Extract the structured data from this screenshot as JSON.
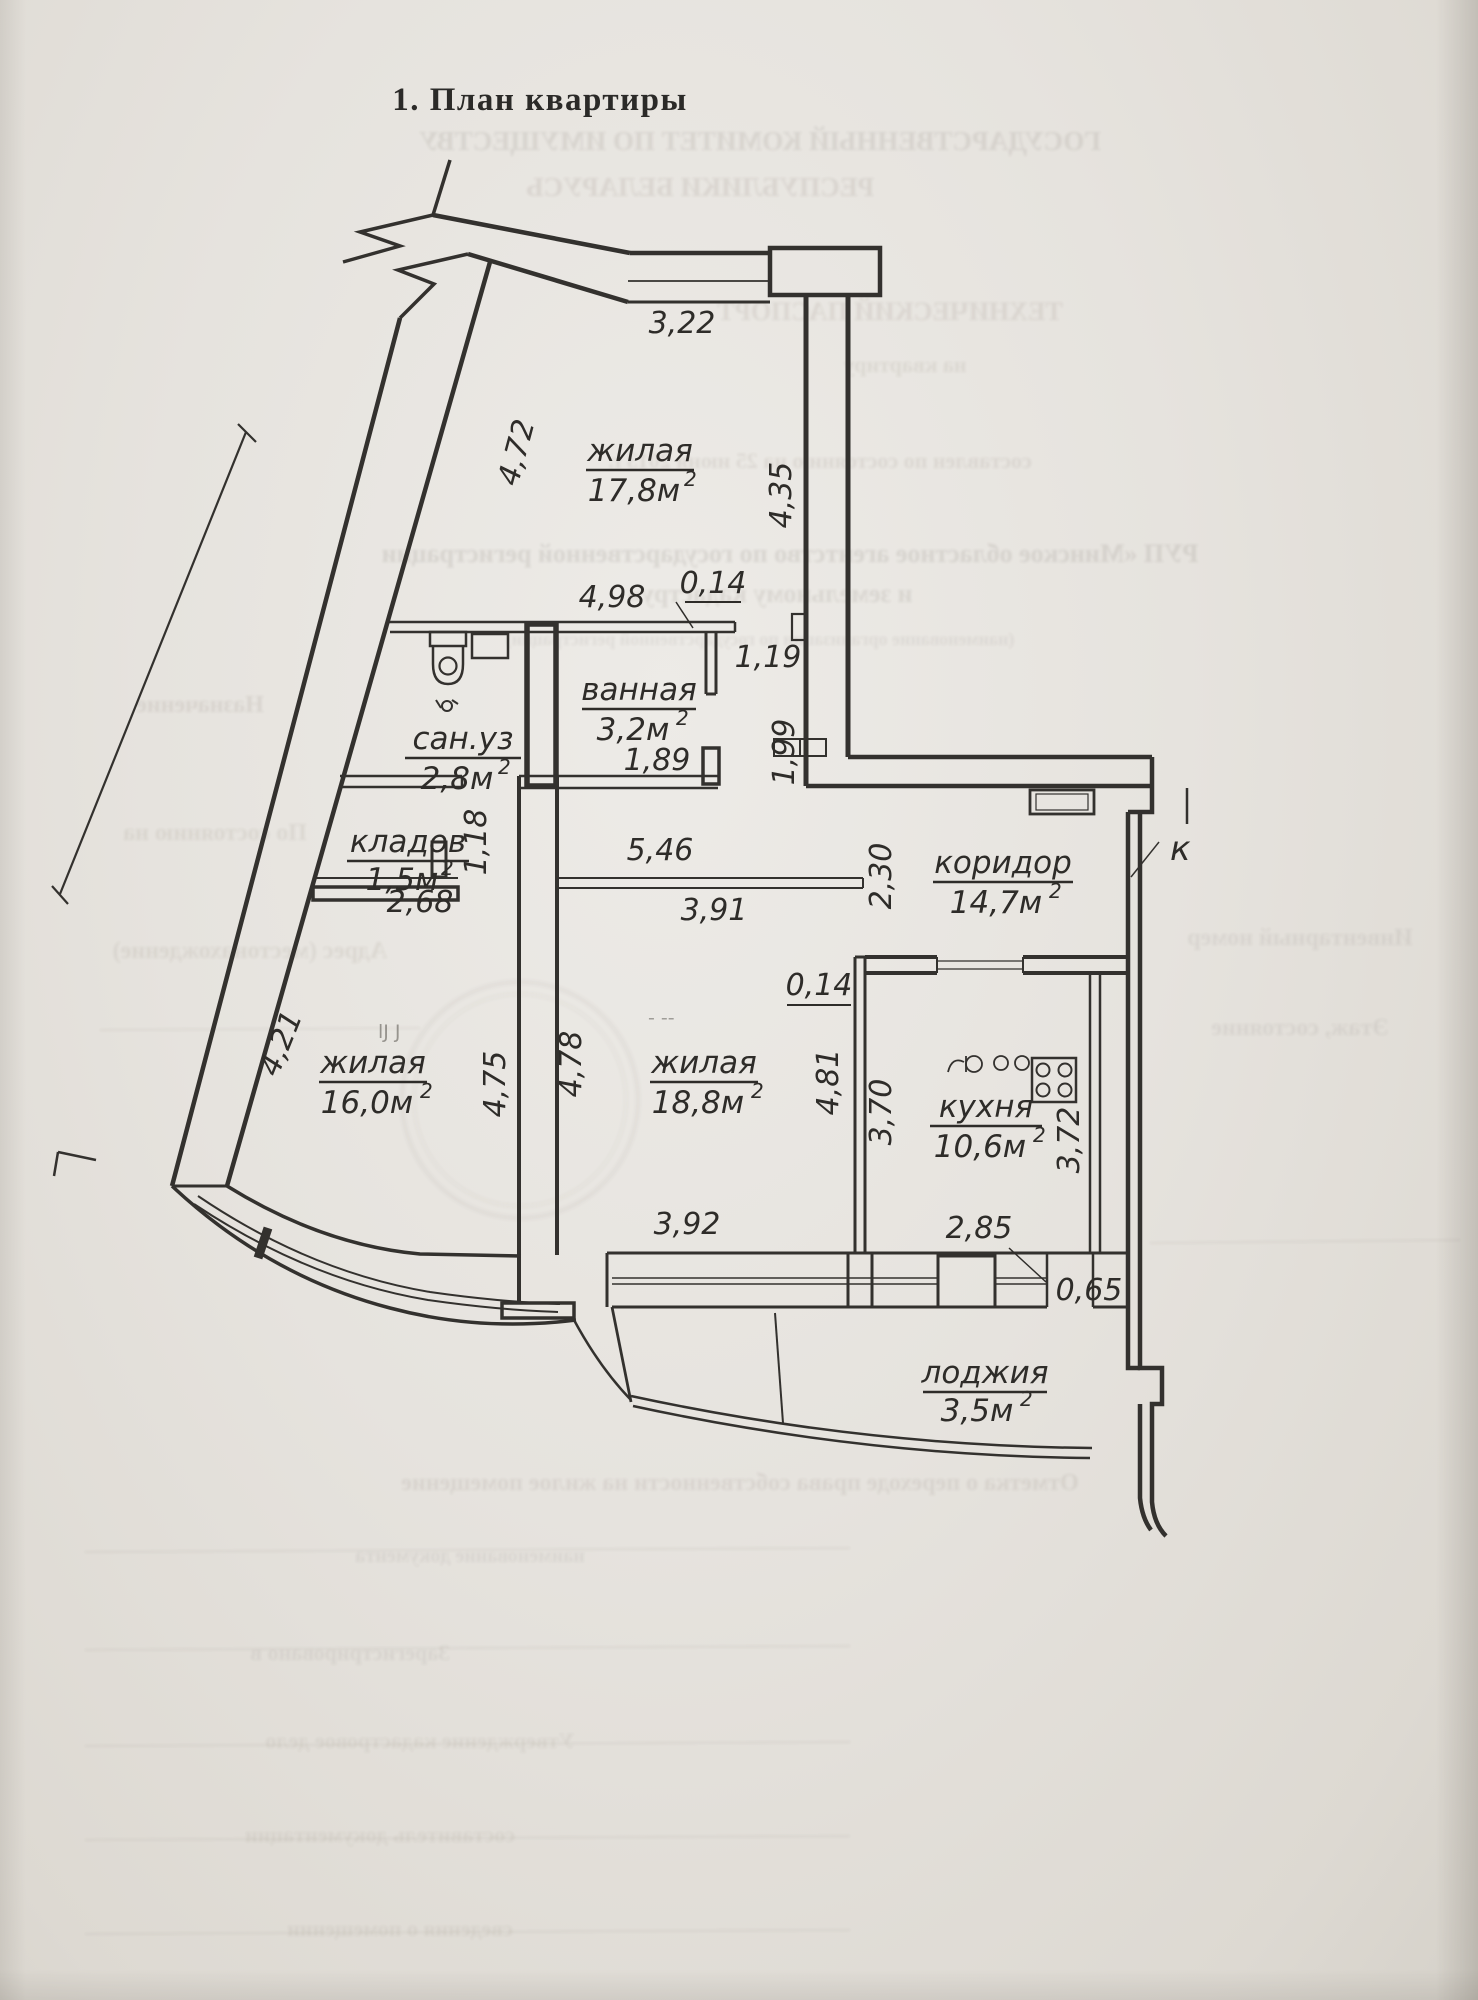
{
  "title": "1. План квартиры",
  "plan": {
    "rooms": [
      {
        "id": "living-top",
        "name": "жилая",
        "area": "17,8м",
        "sup": "2"
      },
      {
        "id": "bathroom",
        "name": "ванная",
        "area": "3,2м",
        "sup": "2"
      },
      {
        "id": "wc",
        "name": "сан.уз",
        "area": "2,8м",
        "sup": "2"
      },
      {
        "id": "closet",
        "name": "кладов",
        "area": "1,5м",
        "sup": "2"
      },
      {
        "id": "corridor",
        "name": "коридор",
        "area": "14,7м",
        "sup": "2"
      },
      {
        "id": "kitchen",
        "name": "кухня",
        "area": "10,6м",
        "sup": "2"
      },
      {
        "id": "living-left",
        "name": "жилая",
        "area": "16,0м",
        "sup": "2"
      },
      {
        "id": "living-mid",
        "name": "жилая",
        "area": "18,8м",
        "sup": "2"
      },
      {
        "id": "loggia",
        "name": "лоджия",
        "area": "3,5м",
        "sup": "2"
      }
    ],
    "dims": {
      "top_window": "3,22",
      "entry_wall": "4,72",
      "living_top_right": "4,35",
      "bath_top": "4,98",
      "bath_wall_thk": "0,14",
      "bath_stub": "1,19",
      "bath_width": "1,89",
      "niche_height": "1,99",
      "closet_depth": "1,18",
      "closet_width": "2,68",
      "beam": "5,46",
      "opening": "3,91",
      "corridor_left": "2,30",
      "partition_thk": "0,14",
      "living_left_wall": "4,21",
      "living_left_right": "4,75",
      "living_mid_left": "4,78",
      "living_mid_right": "4,81",
      "kitchen_left": "3,70",
      "kitchen_right": "3,72",
      "living_mid_window": "3,92",
      "kitchen_window": "2,85",
      "loggia_jamb": "0,65"
    },
    "marks": {
      "entry": "к",
      "pencil1": "lJ J",
      "pencil2": "- --"
    }
  },
  "bleedthrough": [
    "ГОСУДАРСТВЕННЫЙ КОМИТЕТ ПО ИМУЩЕСТВУ",
    "РЕСПУБЛИКИ БЕЛАРУСЬ",
    "ТЕХНИЧЕСКИЙ ПАСПОРТ",
    "на квартиру",
    "составлен по состоянию на 25 июня 2013 г.",
    "РУП «Минское областное агентство по государственной регистрации",
    "и земельному кадастру»",
    "(наименование организации по государственной регистрации)",
    "Назначение",
    "По состоянию на",
    "Адрес (местонахождение)",
    "Инвентарный номер",
    "Этаж, состояние",
    "Отметка о переходе права собственности на жилое помещение",
    "наименование документа",
    "Зарегистрировано в",
    "Утверждение кадастровое дело",
    "составитель документации",
    "сведения о помещении"
  ]
}
